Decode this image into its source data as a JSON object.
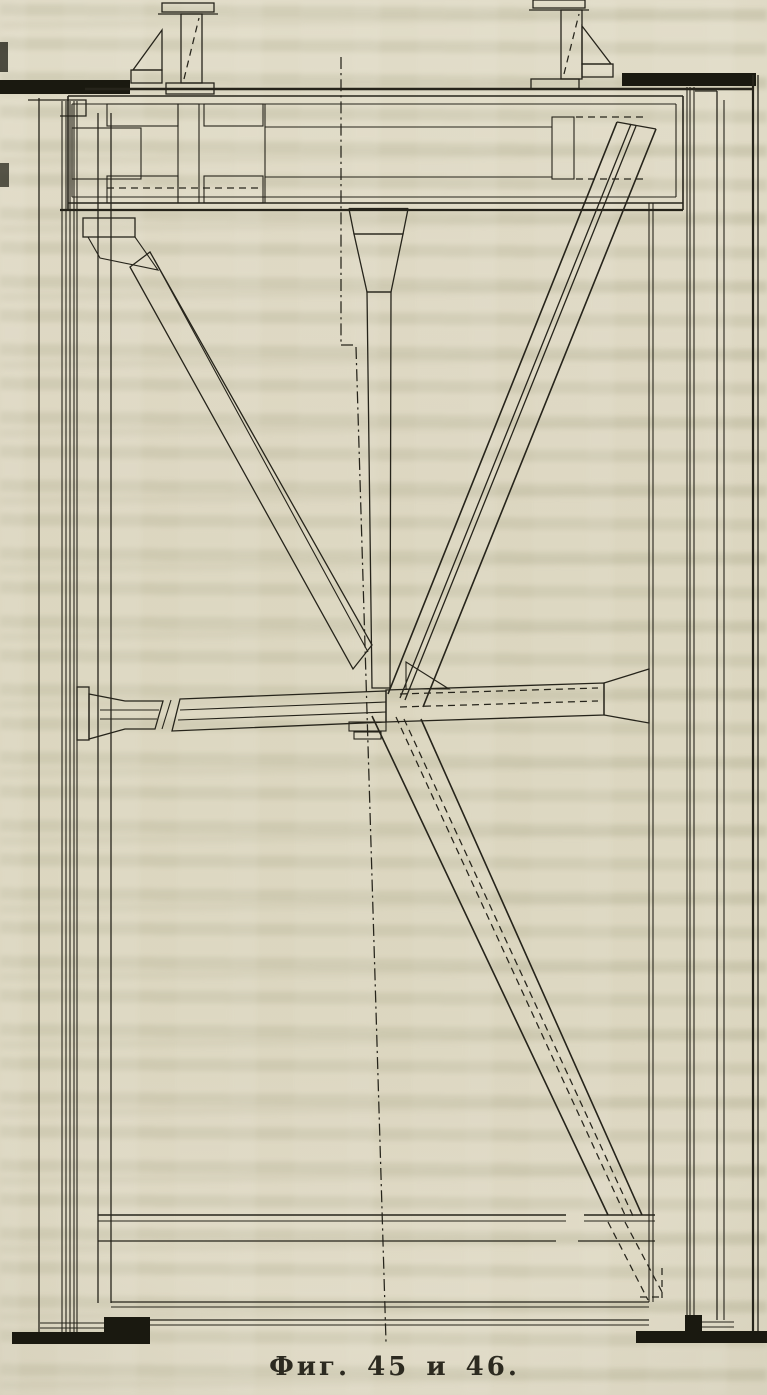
{
  "page": {
    "kind": "scanned-technical-figure",
    "caption": "Фиг. 45 и 46.",
    "figure_numbers": [
      "45",
      "46"
    ]
  },
  "colors": {
    "paper": "#d8d2b9",
    "paper_light": "#ded8c2",
    "ink": "#26241b",
    "ink_dark": "#1a1910",
    "ghost_text": "#b2af92",
    "caption_ink": "#2c2a20"
  }
}
